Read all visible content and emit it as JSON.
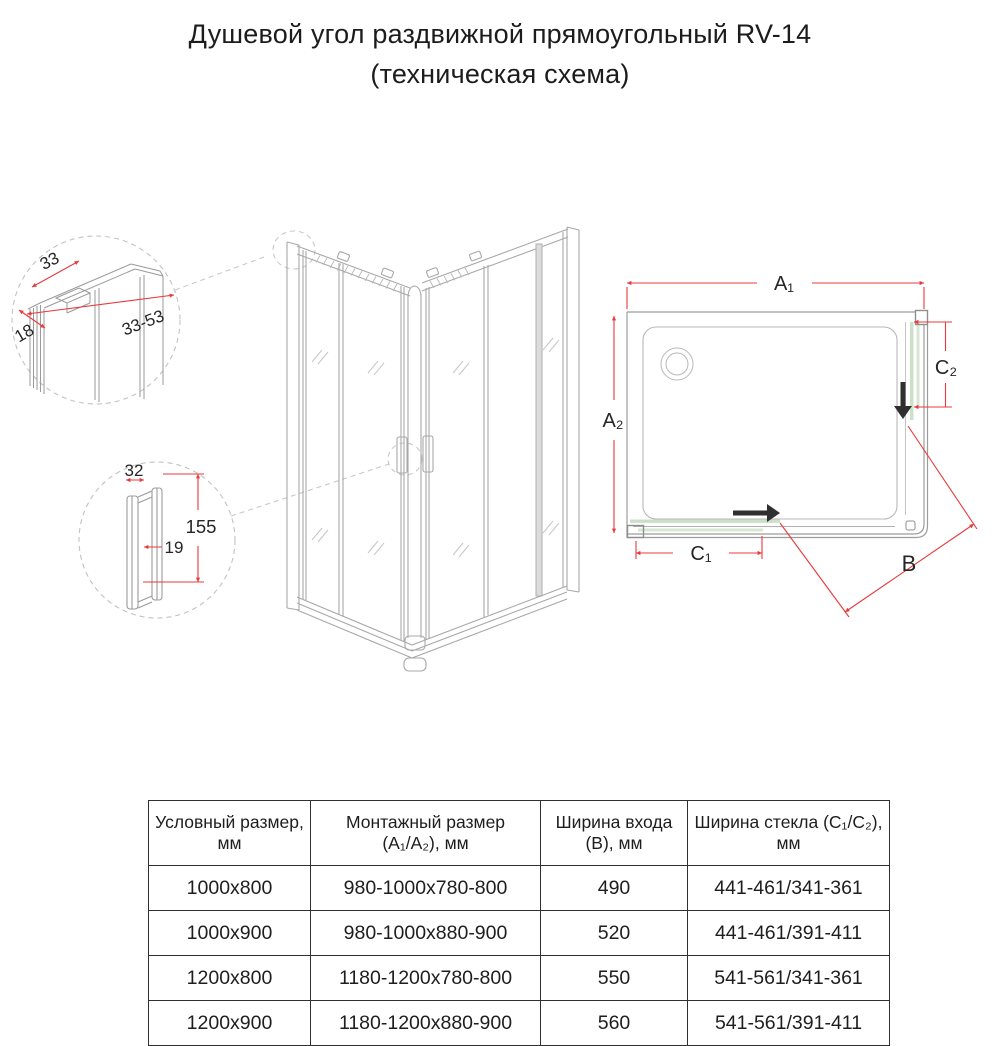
{
  "title": {
    "line1": "Душевой угол раздвижной прямоугольный RV-14",
    "line2": "(техническая схема)"
  },
  "drawing": {
    "profile_detail": {
      "width_top": "33",
      "depth": "18",
      "range": "33-53"
    },
    "handle_detail": {
      "width": "32",
      "gap": "19",
      "height": "155"
    },
    "plan": {
      "a1": "A₁",
      "a2": "A₂",
      "b": "B",
      "c1": "C₁",
      "c2": "C₂"
    },
    "colors": {
      "dimension_red": "#e8393c",
      "glass_green": "#cbe0c6",
      "glass_green_light": "#d7e7d2",
      "line_gray": "#a8a8a8",
      "arrow_black": "#2f2f2f"
    }
  },
  "table": {
    "headers": [
      "Условный размер, мм",
      "Монтажный размер (A₁/A₂), мм",
      "Ширина входа (B), мм",
      "Ширина стекла (C₁/C₂), мм"
    ],
    "rows": [
      [
        "1000x800",
        "980-1000x780-800",
        "490",
        "441-461/341-361"
      ],
      [
        "1000x900",
        "980-1000x880-900",
        "520",
        "441-461/391-411"
      ],
      [
        "1200x800",
        "1180-1200x780-800",
        "550",
        "541-561/341-361"
      ],
      [
        "1200x900",
        "1180-1200x880-900",
        "560",
        "541-561/391-411"
      ]
    ]
  }
}
